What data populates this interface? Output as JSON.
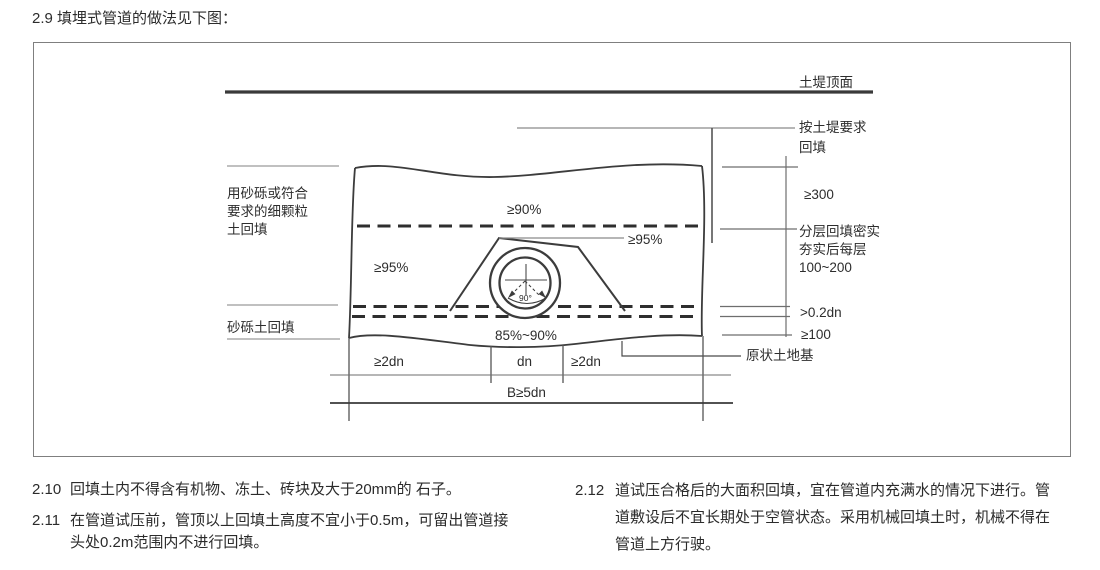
{
  "page": {
    "title": "2.9 填埋式管道的做法见下图："
  },
  "colors": {
    "ink": "#2d2d2d",
    "drawing_line": "#3c3c3c",
    "thin_dim_line": "#8a8a8a",
    "frame_border": "#7f7f7f",
    "background": "#ffffff"
  },
  "diagram": {
    "left_labels": {
      "fine_soil_lines": [
        "用砂砾或符合",
        "要求的细颗粒",
        "土回填"
      ],
      "gravel_backfill": "砂砾土回填"
    },
    "right_labels": {
      "embankment_top_surface": "土堤顶面",
      "embankment_backfill_lines": [
        "按土堤要求",
        "回填"
      ],
      "dim_300": "≥300",
      "layered_lines": [
        "分层回填密实",
        "夯实后每层",
        "100~200"
      ],
      "dim_02dn": ">0.2dn",
      "dim_100": "≥100",
      "undisturbed_soil": "原状土地基"
    },
    "compaction_zones": {
      "top": "≥90%",
      "middle_left": "≥95%",
      "middle_right": "≥95%",
      "bottom": "85%~90%"
    },
    "bottom_dims": {
      "left_2dn": "≥2dn",
      "dn": "dn",
      "right_2dn": "≥2dn",
      "b_5dn": "B≥5dn"
    },
    "pipe": {
      "angle_label": "90°"
    }
  },
  "notes": [
    {
      "no": "2.10",
      "text": "回填土内不得含有机物、冻土、砖块及大于20mm的 石子。"
    },
    {
      "no": "2.11",
      "text": "在管道试压前，管顶以上回填土高度不宜小于0.5m，可留出管道接头处0.2m范围内不进行回填。"
    },
    {
      "no": "2.12",
      "text": "道试压合格后的大面积回填，宜在管道内充满水的情况下进行。管道敷设后不宜长期处于空管状态。采用机械回填土时，机械不得在管道上方行驶。"
    }
  ]
}
